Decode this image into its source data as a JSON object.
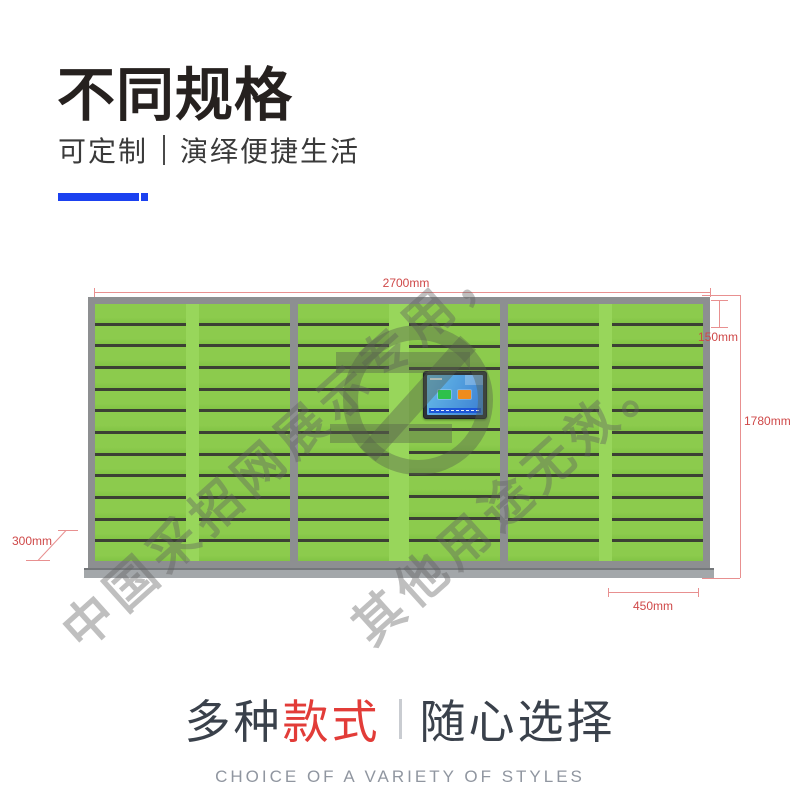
{
  "header": {
    "title": "不同规格",
    "subtitle_left": "可定制",
    "subtitle_right": "演绎便捷生活",
    "accent_color": "#1b41f0"
  },
  "diagram": {
    "dimension_label_color": "#cf4848",
    "dimension_line_color": "#e89090",
    "labels": {
      "width": "2700mm",
      "cell_height": "150mm",
      "height": "1780mm",
      "column_width": "450mm",
      "depth": "300mm"
    },
    "watermark": {
      "line1": "中国采招网展示专用，",
      "line2": "其他用途无效。"
    },
    "locker": {
      "columns": 6,
      "rows_per_column": 12,
      "door_color": "#8ccb4d",
      "strip_color": "#98d65b",
      "frame_color": "#8d8f91",
      "separator_color": "#3c4034",
      "screen": {
        "bezel_color": "#2e3338",
        "display_color_top": "#66bce9",
        "display_color_bottom": "#3c7fd2",
        "button_green": "#2ec14c",
        "button_orange": "#ef8c1e",
        "bottom_bar_color": "#1d56d8"
      }
    }
  },
  "footer": {
    "title_part1": "多种",
    "title_part2": "款式",
    "title_part3": "随心选择",
    "subtitle": "CHOICE OF A VARIETY OF STYLES",
    "red_color": "#e23c38",
    "text_color": "#3a414b",
    "subtitle_color": "#9096a0"
  }
}
